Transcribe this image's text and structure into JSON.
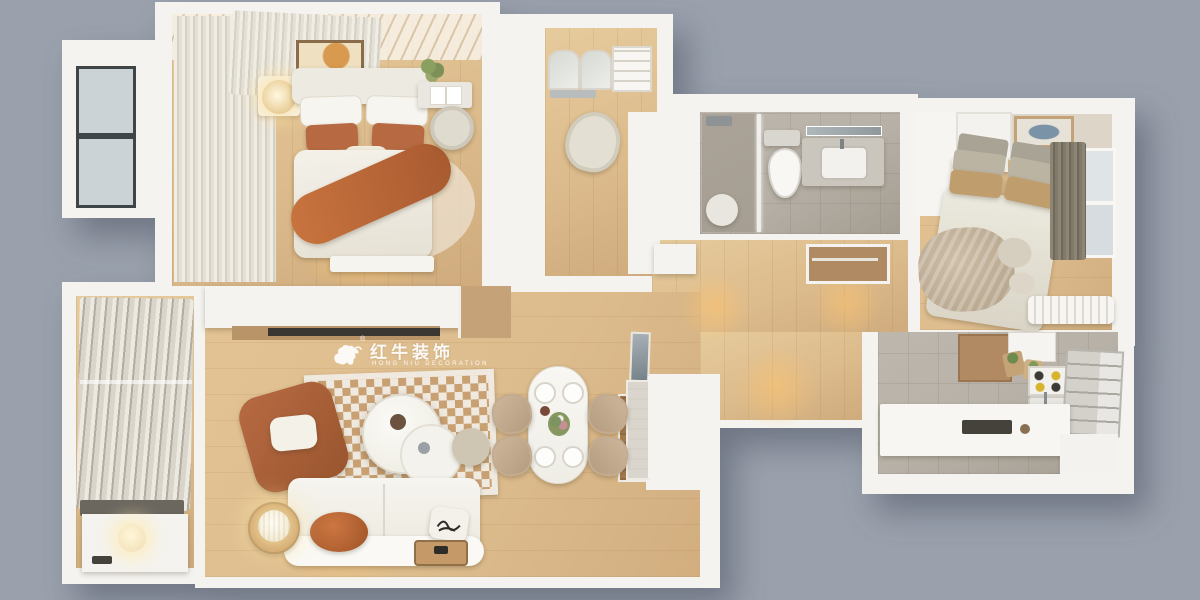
{
  "scene": {
    "type": "3d-floorplan-top-view",
    "style": "warm minimalist apartment render on gray backdrop"
  },
  "watermark": {
    "brand_cn": "红牛装饰",
    "brand_en": "HONG NIU DECORATION",
    "registered": "®",
    "logo": "bull-icon"
  },
  "palette": {
    "bg": "#9aa1ad",
    "wall": "#f4f3ef",
    "wall_shade": "#e3e0da",
    "wood": "#dcbb8c",
    "wood_light": "#e6cb9d",
    "tile": "#b7b1a7",
    "tile_dark": "#a59e93",
    "terracotta": "#b76a42",
    "terracotta_dark": "#99552e",
    "cream": "#efe9df",
    "rug_tan": "#c9a071",
    "beige": "#c8b59c",
    "curtain_gray": "#837b6b",
    "glow": "#ffc46e"
  },
  "rooms": [
    {
      "name": "master-bedroom",
      "furniture": [
        "sheer-curtains",
        "bay-window",
        "wall-art",
        "double-bed",
        "white-bedding",
        "terracotta-pillows",
        "terracotta-throw",
        "nightstand",
        "glowing-table-lamp",
        "desk",
        "open-book",
        "round-chair",
        "plant",
        "foot-bench",
        "area-rug"
      ]
    },
    {
      "name": "study",
      "furniture": [
        "arched-glass-cabinets",
        "open-shelf",
        "task-chair",
        "wardrobe-block"
      ]
    },
    {
      "name": "bathroom",
      "furniture": [
        "walk-in-shower",
        "glass-partition",
        "round-mat",
        "toilet",
        "vanity-counter",
        "sink",
        "mirror"
      ]
    },
    {
      "name": "second-bedroom",
      "furniture": [
        "wardrobe",
        "headboard-shelf",
        "wall-art",
        "double-bed",
        "tan-pillows",
        "tan-throw",
        "window",
        "gray-curtain",
        "radiator"
      ]
    },
    {
      "name": "kitchen",
      "furniture": [
        "wood-upper-cabinet",
        "white-cabinet",
        "grocery-bags",
        "cooktop",
        "sink",
        "refrigerator",
        "counter",
        "dark-hob"
      ]
    },
    {
      "name": "hallway",
      "furniture": [
        "coat-closet",
        "console",
        "entry-door",
        "warm-ceiling-light-pools"
      ]
    },
    {
      "name": "living-dining",
      "furniture": [
        "floating-tv-cabinet",
        "media-shelf",
        "wood-side-box",
        "leaning-mirror",
        "display-cabinet",
        "checkerboard-rug",
        "two-tier-coffee-table",
        "terracotta-armchair",
        "white-sofa",
        "orange-cushion",
        "graphic-pillow",
        "side-table",
        "paper-lantern-lamp",
        "floor-tray",
        "oval-dining-table",
        "place-settings",
        "flower-centerpiece",
        "dining-chairs",
        "pouf"
      ]
    },
    {
      "name": "balcony",
      "furniture": [
        "sheer-curtain-stack",
        "laundry-counter",
        "washer-cabinet",
        "glowing-light"
      ]
    }
  ]
}
